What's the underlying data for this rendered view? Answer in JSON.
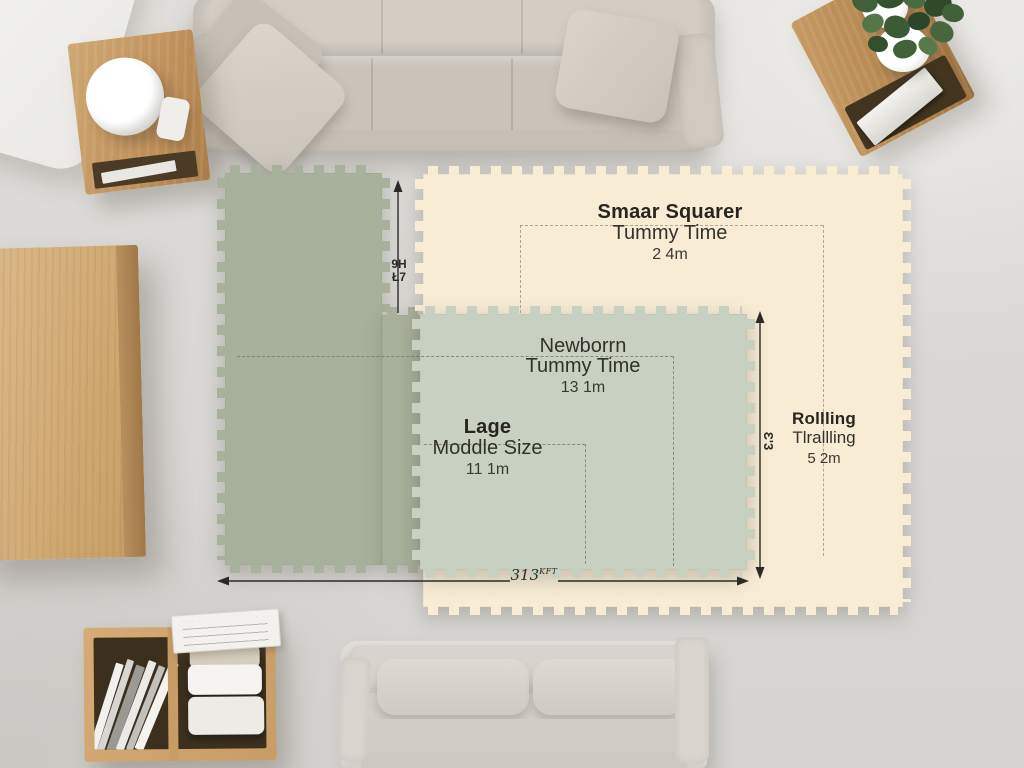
{
  "labels": {
    "small_square": {
      "line1": "Smaar Squarer",
      "line2": "Tummy Time",
      "line3": "2 4m"
    },
    "newborn": {
      "line1": "Newborrn",
      "line2": "Tummy Time",
      "line3": "13 1m"
    },
    "large_middle": {
      "line1": "Lage",
      "line2": "Moddle Size",
      "line3": "11 1m"
    },
    "rolling": {
      "line1": "Rollling",
      "line2": "Tlrallling",
      "line3": "5 2m"
    }
  },
  "dimensions": {
    "height_left": {
      "line1": "9H",
      "line2": "Ł7"
    },
    "height_right": {
      "text": "Ɛ'3"
    },
    "width_bottom": {
      "value": "313",
      "unit": "KFT"
    }
  },
  "colors": {
    "floor": "#dad8d5",
    "mat_cream": "#f8ecd5",
    "mat_green_dark": "#a8b19b",
    "mat_green_light": "#c8d0c1",
    "wood": "#c79c67",
    "sofa": "#cbc5bc",
    "annotation": "#2b2a26"
  }
}
